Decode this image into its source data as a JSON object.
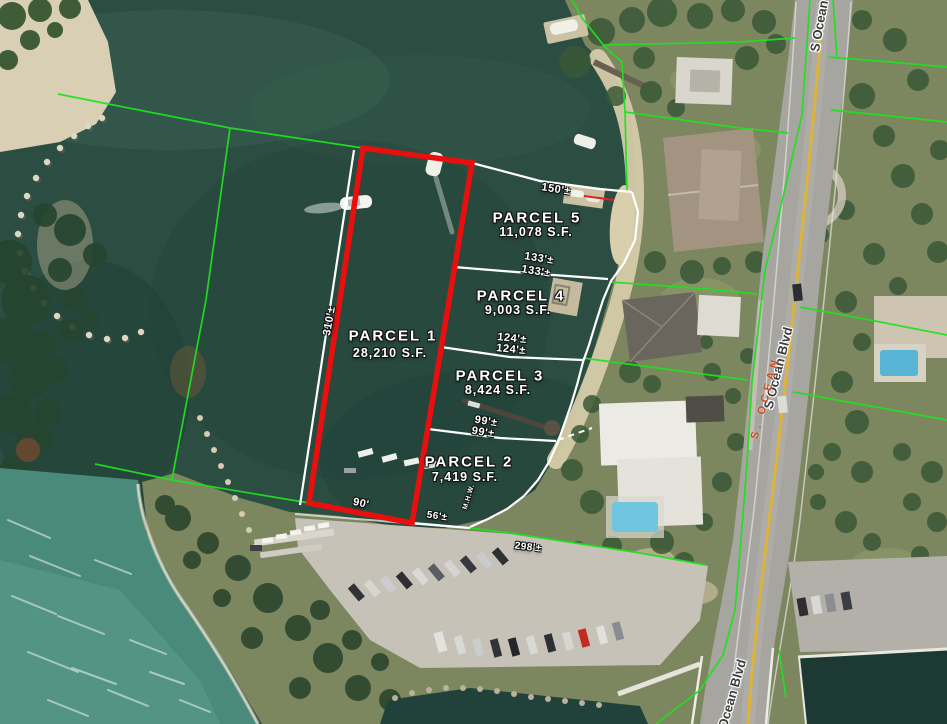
{
  "parcels": [
    {
      "name": "PARCEL  1",
      "area": "28,210  S.F."
    },
    {
      "name": "PARCEL  2",
      "area": "7,419  S.F."
    },
    {
      "name": "PARCEL  3",
      "area": "8,424  S.F."
    },
    {
      "name": "PARCEL  4",
      "area": "9,003  S.F."
    },
    {
      "name": "PARCEL  5",
      "area": "11,078  S.F."
    }
  ],
  "dimensions": {
    "parcel5_north": "150'±",
    "parcel5_south_a": "133'±",
    "parcel5_south_b": "133'±",
    "parcel4_south_a": "124'±",
    "parcel4_south_b": "124'±",
    "parcel3_south_a": "99'±",
    "parcel3_south_b": "99'±",
    "parcel1_west": "310'±",
    "parcel1_south": "90'",
    "parcel2_south": "56'±",
    "waterfront_south": "298'±",
    "mean_high_water": "M.H.W."
  },
  "streets": {
    "label_top": "S Ocean",
    "label_middle": "S Ocean Blvd",
    "label_bottom": "Ocean Blvd",
    "survey_road_label": "S. OCEAN"
  },
  "colors": {
    "parcel_highlight_red": "#e80f0f",
    "cadastral_green": "#1fe11f",
    "survey_line_white": "#ffffff",
    "street_label_gray": "#3c3c3c",
    "survey_street_red": "#c8502a"
  }
}
